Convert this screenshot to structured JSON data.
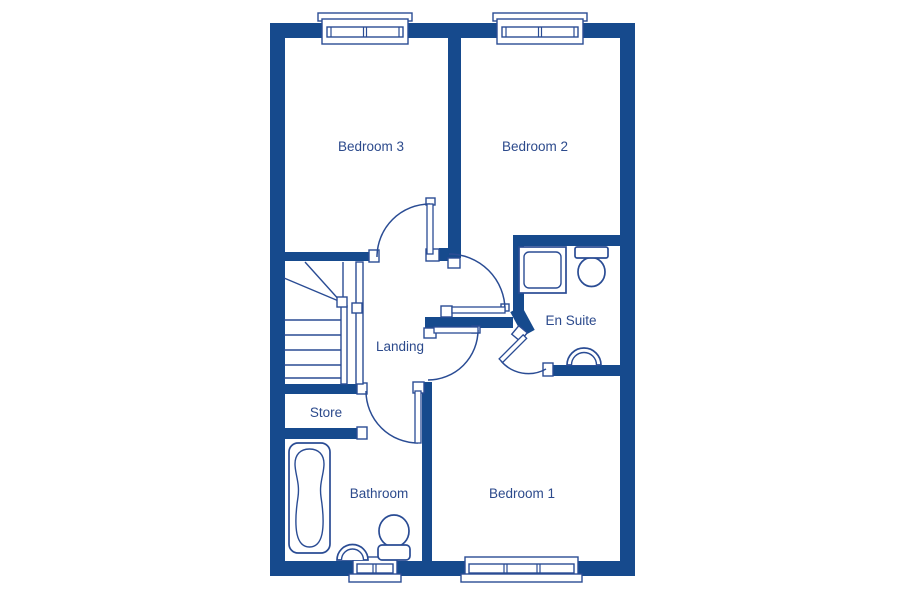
{
  "colors": {
    "wall": "#164a8d",
    "line": "#2a4c94",
    "label": "#2c4a8c",
    "background": "#ffffff"
  },
  "floorplan": {
    "type": "floor-plan",
    "rooms": {
      "bedroom3": {
        "label": "Bedroom 3"
      },
      "bedroom2": {
        "label": "Bedroom 2"
      },
      "ensuite": {
        "label": "En Suite"
      },
      "landing": {
        "label": "Landing"
      },
      "store": {
        "label": "Store"
      },
      "bathroom": {
        "label": "Bathroom"
      },
      "bedroom1": {
        "label": "Bedroom 1"
      }
    },
    "fixtures": [
      "shower-tray-icon",
      "toilet-icon-ensuite",
      "sink-icon-ensuite",
      "bath-icon",
      "sink-icon-bathroom",
      "toilet-icon-bathroom",
      "staircase-icon"
    ],
    "windows": [
      "bedroom3-window",
      "bedroom2-window",
      "bathroom-window",
      "bedroom1-window"
    ],
    "doors": [
      "bedroom3-door",
      "bedroom2-door",
      "bedroom1-door",
      "ensuite-door",
      "bathroom-door"
    ]
  }
}
